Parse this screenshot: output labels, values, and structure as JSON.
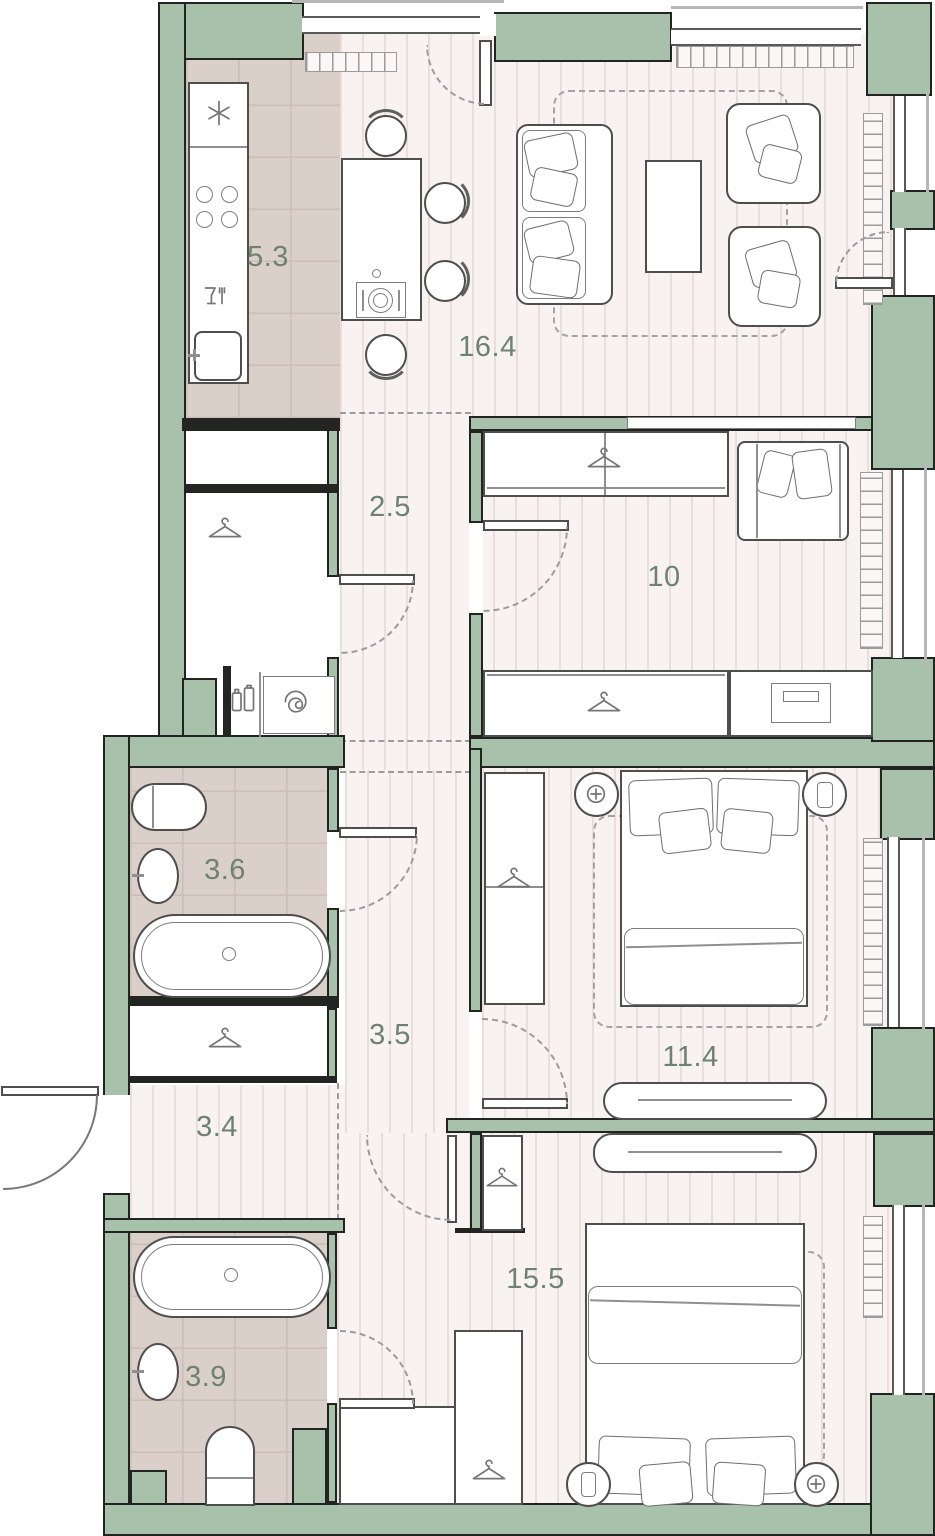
{
  "rooms": {
    "kitchen": {
      "label": "5.3"
    },
    "living_room": {
      "label": "16.4"
    },
    "hallway": {
      "label": "2.5"
    },
    "bedroom_small": {
      "label": "10"
    },
    "bathroom_main": {
      "label": "3.6"
    },
    "corridor": {
      "label": "3.5"
    },
    "entry_hall": {
      "label": "3.4"
    },
    "bedroom_middle": {
      "label": "11.4"
    },
    "bathroom_second": {
      "label": "3.9"
    },
    "bedroom_master": {
      "label": "15.5"
    }
  },
  "colors": {
    "wall_fill": "#a8c1ab",
    "wall_outline": "#212421",
    "floor_striped": "#f8f2f1",
    "floor_stripe_line": "#eadedc",
    "floor_tiled": "#dbcfca",
    "label_text": "#6e8270",
    "furniture_outline": "#4e4e4e"
  },
  "icons": {
    "hanger": "clothes-hanger",
    "spiral": "washing-machine-drum",
    "asterisk": "freezer-snowflake",
    "burners": "stove-burners",
    "glass_fork": "dishwasher-glass-fork",
    "plus_circle": "bedside-lamp",
    "phone": "phone-on-nightstand",
    "detergent": "detergent-bottles"
  }
}
